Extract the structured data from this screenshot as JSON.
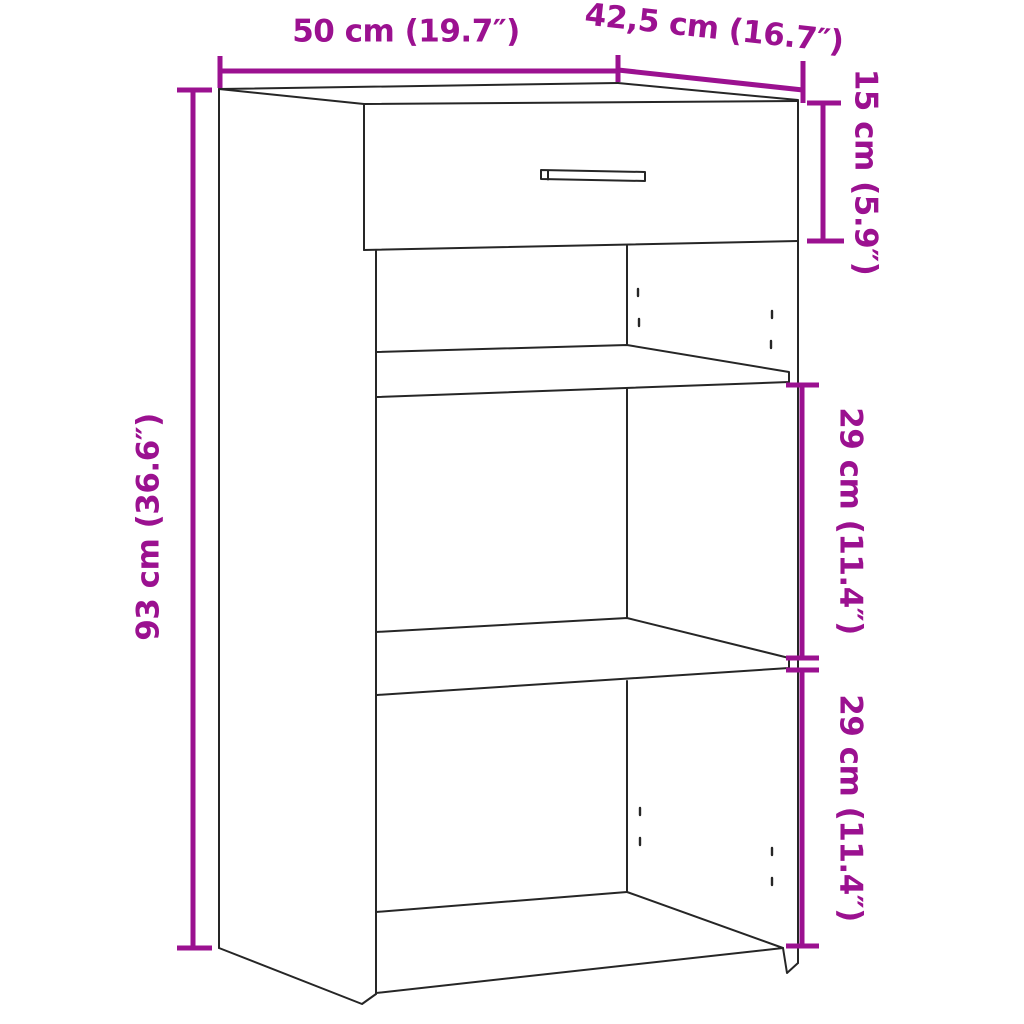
{
  "diagram": {
    "subject": "cabinet with one drawer and two open shelf compartments",
    "dimensions": {
      "width": "50 cm (19.7″)",
      "depth": "42,5 cm (16.7″)",
      "drawer_height": "15 cm (5.9″)",
      "total_height": "93 cm (36.6″)",
      "upper_compartment_height": "29 cm (11.4″)",
      "lower_compartment_height": "29 cm (11.4″)"
    },
    "colors": {
      "dimension_accent": "#9B1190",
      "line": "#262626",
      "background": "#FFFFFF"
    }
  }
}
